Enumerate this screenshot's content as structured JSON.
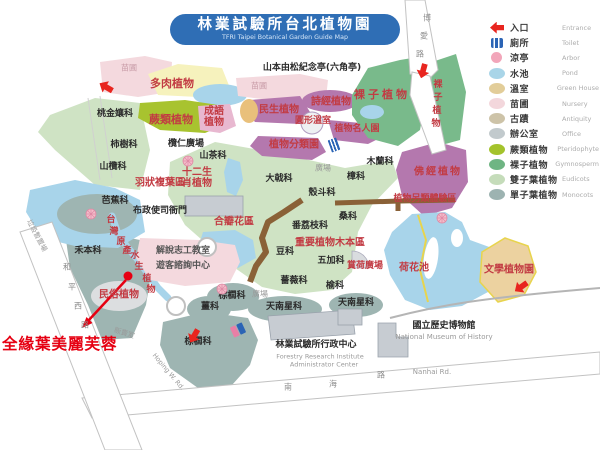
{
  "title": {
    "zh": "林業試驗所台北植物園",
    "en": "TFRI Taipei Botanical Garden Guide Map"
  },
  "annotation": {
    "text": "全緣葉美麗芙蓉"
  },
  "colors": {
    "banner-blue": "#2f6eb5",
    "entrance-red": "#e8251f",
    "annotation-red": "#e60012",
    "theme-red": "#c23b43",
    "eudicot": "#cfe3c4",
    "monocot": "#9eb5b2",
    "fern": "#a8c32f",
    "gymnosperm": "#79ba8b",
    "pond": "#a8d4ea",
    "nursery": "#f4d9de",
    "theme-purple": "#b478ae",
    "road-edge": "#c2c2c2"
  },
  "legend": {
    "items": [
      {
        "zh": "入口",
        "en": "Entrance",
        "shape": "arrow",
        "color": "#e8251f"
      },
      {
        "zh": "廁所",
        "en": "Toilet",
        "shape": "toilet",
        "color": "#2b64b5"
      },
      {
        "zh": "涼亭",
        "en": "Arbor",
        "shape": "circle",
        "color": "#f2a6ba"
      },
      {
        "zh": "水池",
        "en": "Pond",
        "shape": "ellipse",
        "color": "#a9d5e8"
      },
      {
        "zh": "溫室",
        "en": "Green House",
        "shape": "ellipse",
        "color": "#e2cd99"
      },
      {
        "zh": "苗圃",
        "en": "Nursery",
        "shape": "ellipse",
        "color": "#f3d7dc"
      },
      {
        "zh": "古蹟",
        "en": "Antiquity",
        "shape": "ellipse",
        "color": "#cdc3a8"
      },
      {
        "zh": "辦公室",
        "en": "Office",
        "shape": "ellipse",
        "color": "#c2cacd"
      },
      {
        "zh": "蕨類植物",
        "en": "Pteridophyte",
        "shape": "ellipse",
        "color": "#a4c32c"
      },
      {
        "zh": "裸子植物",
        "en": "Gymnosperm",
        "shape": "ellipse",
        "color": "#6fb583"
      },
      {
        "zh": "雙子葉植物",
        "en": "Eudicots",
        "shape": "ellipse",
        "color": "#c5dcba"
      },
      {
        "zh": "單子葉植物",
        "en": "Monocots",
        "shape": "ellipse",
        "color": "#9db3b1"
      }
    ]
  },
  "map": {
    "black_labels": [
      {
        "t": "桃金孃科",
        "x": 115,
        "y": 115
      },
      {
        "t": "柿樹科",
        "x": 124,
        "y": 146
      },
      {
        "t": "山欖科",
        "x": 113,
        "y": 168
      },
      {
        "t": "芭蕉科",
        "x": 115,
        "y": 202
      },
      {
        "t": "禾本科",
        "x": 88,
        "y": 252
      },
      {
        "t": "山茶科",
        "x": 213,
        "y": 157
      },
      {
        "t": "欖仁廣場",
        "x": 186,
        "y": 145
      },
      {
        "t": "大戟科",
        "x": 279,
        "y": 180
      },
      {
        "t": "殼斗科",
        "x": 322,
        "y": 194
      },
      {
        "t": "樟科",
        "x": 356,
        "y": 178
      },
      {
        "t": "木蘭科",
        "x": 380,
        "y": 163
      },
      {
        "t": "桑科",
        "x": 348,
        "y": 218
      },
      {
        "t": "番荔枝科",
        "x": 310,
        "y": 227
      },
      {
        "t": "豆科",
        "x": 285,
        "y": 253
      },
      {
        "t": "五加科",
        "x": 331,
        "y": 262
      },
      {
        "t": "薔薇科",
        "x": 294,
        "y": 282
      },
      {
        "t": "榆科",
        "x": 335,
        "y": 287
      },
      {
        "t": "棕櫚科",
        "x": 232,
        "y": 297
      },
      {
        "t": "薑科",
        "x": 210,
        "y": 308
      },
      {
        "t": "天南星科",
        "x": 284,
        "y": 308
      },
      {
        "t": "天南星科",
        "x": 356,
        "y": 304
      },
      {
        "t": "棕櫚科",
        "x": 198,
        "y": 343
      },
      {
        "t": "山本由松紀念亭(六角亭)",
        "x": 312,
        "y": 69
      },
      {
        "t": "布政使司衙門",
        "x": 160,
        "y": 212
      },
      {
        "t": "解說志工教室",
        "x": 183,
        "y": 252,
        "c": "#555555"
      },
      {
        "t": "遊客諮詢中心",
        "x": 183,
        "y": 267,
        "c": "#555555"
      },
      {
        "t": "林業試驗所行政中心",
        "x": 316,
        "y": 346
      },
      {
        "t": "國立歷史博物館",
        "x": 444,
        "y": 327
      }
    ],
    "red_labels": [
      {
        "t": "多肉植物",
        "x": 172,
        "y": 84,
        "s": 11
      },
      {
        "t": "蕨類植物",
        "x": 171,
        "y": 120,
        "s": 11
      },
      {
        "t": "成語\n植物",
        "x": 214,
        "y": 117
      },
      {
        "t": "民生植物",
        "x": 279,
        "y": 110
      },
      {
        "t": "詩經植物",
        "x": 331,
        "y": 102
      },
      {
        "t": "圓形溫室",
        "x": 313,
        "y": 122,
        "s": 9
      },
      {
        "t": "植物名人園",
        "x": 357,
        "y": 130,
        "s": 9
      },
      {
        "t": "植物分類園",
        "x": 294,
        "y": 145
      },
      {
        "t": "裸子植物",
        "x": 382,
        "y": 95,
        "s": 11,
        "ls": 3
      },
      {
        "t": "佛經植物",
        "x": 438,
        "y": 172,
        "ls": 2
      },
      {
        "t": "植物另類體驗區",
        "x": 425,
        "y": 200,
        "s": 9
      },
      {
        "t": "羽狀複葉區",
        "x": 160,
        "y": 183
      },
      {
        "t": "十二生\n肖植物",
        "x": 197,
        "y": 178
      },
      {
        "t": "合瓣花區",
        "x": 234,
        "y": 222
      },
      {
        "t": "重要植物木本區",
        "x": 330,
        "y": 243
      },
      {
        "t": "賞荷廣場",
        "x": 365,
        "y": 267,
        "s": 9
      },
      {
        "t": "荷花池",
        "x": 414,
        "y": 268
      },
      {
        "t": "文學植物園",
        "x": 509,
        "y": 270
      },
      {
        "t": "民俗植物",
        "x": 119,
        "y": 295
      }
    ],
    "char_labels": [
      {
        "t": "台",
        "x": 111,
        "y": 221
      },
      {
        "t": "灣",
        "x": 114,
        "y": 233
      },
      {
        "t": "原",
        "x": 121,
        "y": 243
      },
      {
        "t": "產",
        "x": 127,
        "y": 252
      },
      {
        "t": "水",
        "x": 135,
        "y": 257
      },
      {
        "t": "生",
        "x": 139,
        "y": 268
      },
      {
        "t": "植",
        "x": 147,
        "y": 280
      },
      {
        "t": "物",
        "x": 151,
        "y": 291
      },
      {
        "t": "裸",
        "x": 438,
        "y": 86
      },
      {
        "t": "子",
        "x": 438,
        "y": 99
      },
      {
        "t": "植",
        "x": 437,
        "y": 112
      },
      {
        "t": "物",
        "x": 436,
        "y": 125
      }
    ],
    "gray_labels": [
      {
        "t": "苗圃",
        "x": 129,
        "y": 69,
        "c": "#c79aa6"
      },
      {
        "t": "苗圃",
        "x": 259,
        "y": 87,
        "c": "#c79aa6"
      },
      {
        "t": "廣場",
        "x": 323,
        "y": 169
      },
      {
        "t": "廣場",
        "x": 260,
        "y": 295
      },
      {
        "t": "販賣室",
        "x": 124,
        "y": 334,
        "s": 7,
        "r": 18
      },
      {
        "t": "垃圾暫置場",
        "x": 36,
        "y": 236,
        "s": 7,
        "r": 62
      },
      {
        "t": "Forestry Research Institute",
        "x": 320,
        "y": 357,
        "s": 6.5
      },
      {
        "t": "Administrator Center",
        "x": 324,
        "y": 365,
        "s": 6.5
      },
      {
        "t": "National Museum of History",
        "x": 444,
        "y": 338,
        "s": 7
      },
      {
        "t": "Nanhai  Rd.",
        "x": 432,
        "y": 373,
        "s": 7
      },
      {
        "t": "Hoping W. Rd.",
        "x": 168,
        "y": 372,
        "s": 6.5,
        "r": 50
      }
    ],
    "road_chars": [
      {
        "t": "博",
        "x": 427,
        "y": 19
      },
      {
        "t": "愛",
        "x": 424,
        "y": 37
      },
      {
        "t": "路",
        "x": 420,
        "y": 55
      },
      {
        "t": "南",
        "x": 288,
        "y": 388
      },
      {
        "t": "海",
        "x": 333,
        "y": 385
      },
      {
        "t": "路",
        "x": 381,
        "y": 376
      },
      {
        "t": "和",
        "x": 67,
        "y": 268
      },
      {
        "t": "平",
        "x": 72,
        "y": 288
      },
      {
        "t": "西",
        "x": 78,
        "y": 307
      },
      {
        "t": "路",
        "x": 85,
        "y": 326
      }
    ],
    "icons": [
      {
        "type": "entrance-arrow",
        "x": 106,
        "y": 87,
        "r": 30
      },
      {
        "type": "entrance-arrow",
        "x": 423,
        "y": 71,
        "r": -75
      },
      {
        "type": "entrance-arrow",
        "x": 521,
        "y": 287,
        "r": -35
      },
      {
        "type": "entrance-arrow",
        "x": 194,
        "y": 336,
        "r": -60
      },
      {
        "type": "toilet",
        "x": 334,
        "y": 145,
        "r": -20
      },
      {
        "type": "toilet-pair",
        "x": 238,
        "y": 330,
        "r": -25
      },
      {
        "type": "flower",
        "x": 188,
        "y": 158
      },
      {
        "type": "flower",
        "x": 91,
        "y": 211
      },
      {
        "type": "flower",
        "x": 222,
        "y": 286
      },
      {
        "type": "flower",
        "x": 442,
        "y": 215
      }
    ]
  }
}
